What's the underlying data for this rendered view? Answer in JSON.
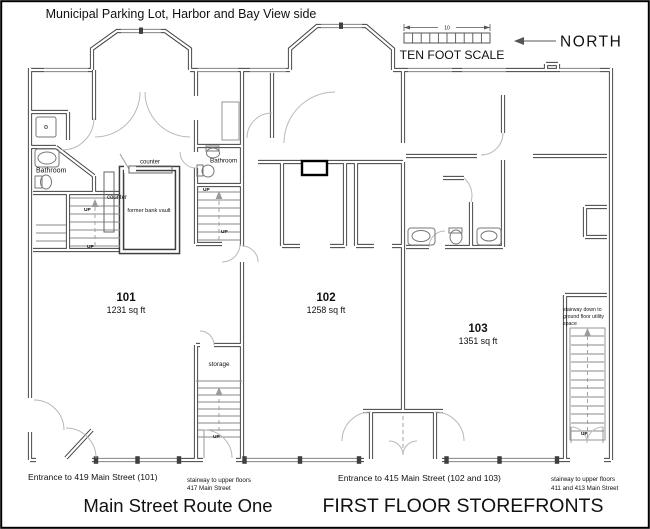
{
  "title_top": "Municipal Parking Lot, Harbor and Bay View side",
  "scale": {
    "label": "TEN FOOT SCALE",
    "dimension": "10"
  },
  "compass": {
    "label": "NORTH"
  },
  "units": [
    {
      "number": "101",
      "area": "1231 sq ft"
    },
    {
      "number": "102",
      "area": "1258 sq ft"
    },
    {
      "number": "103",
      "area": "1351 sq ft"
    }
  ],
  "room_labels": {
    "bathroom_101": "Bathroom",
    "bathroom_core": "Bathroom",
    "counter_top": "counter",
    "counter_side": "counter",
    "vault": "former bank vault",
    "storage": "storage"
  },
  "stair_labels": {
    "up": "UP",
    "down_note_line1": "stairway down to",
    "down_note_line2": "ground floor utility",
    "down_note_line3": "space"
  },
  "street_annotations": {
    "entrance_101": "Entrance to 419 Main Street (101)",
    "stair_417_line1": "stairway to upper floors",
    "stair_417_line2": "417 Main Street",
    "entrance_102_103": "Entrance to 415 Main Street (102 and 103)",
    "stair_411_line1": "stairway to upper floors",
    "stair_411_line2": "411 and 413 Main Street"
  },
  "titles_bottom": {
    "street": "Main Street Route One",
    "plan": "FIRST FLOOR STOREFRONTS"
  },
  "colors": {
    "wall": "#3f3f3f",
    "light_line": "#9a9a9a",
    "text": "#111111",
    "background": "#ffffff",
    "highlight_border": "#000000"
  }
}
